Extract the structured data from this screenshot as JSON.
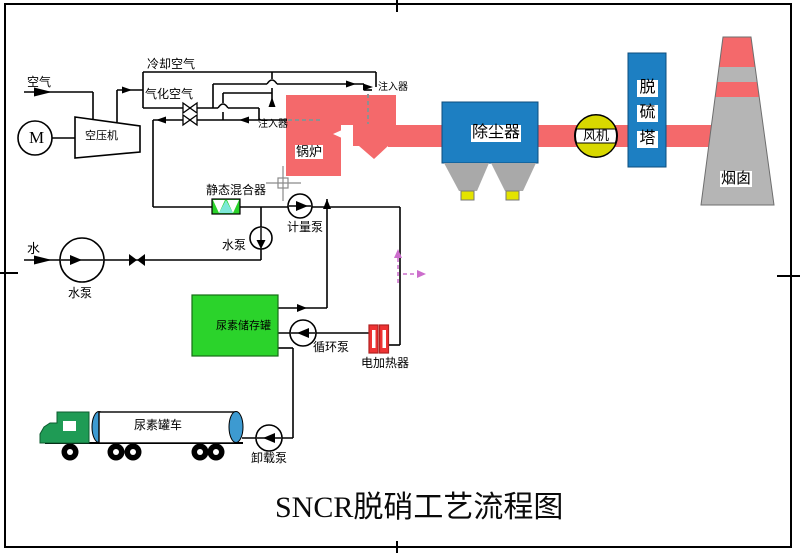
{
  "diagram": {
    "title": "SNCR脱硝工艺流程图",
    "labels": {
      "air": "空气",
      "cooling_air": "冷却空气",
      "atomizing_air": "气化空气",
      "compressor": "空压机",
      "motor": "M",
      "injector_left": "注入器",
      "injector_right": "注入器",
      "boiler": "锅炉",
      "dust_collector": "除尘器",
      "fan": "风机",
      "desulf_tower_chars": [
        "脱",
        "硫",
        "塔"
      ],
      "chimney": "烟囱",
      "static_mixer": "静态混合器",
      "metering_pump": "计量泵",
      "water": "水",
      "water_pump_main": "水泵",
      "water_pump_booster": "水泵",
      "urea_tank": "尿素储存罐",
      "circulation_pump": "循环泵",
      "electric_heater": "电加热器",
      "urea_truck": "尿素罐车",
      "unloading_pump": "卸载泵"
    },
    "colors": {
      "flue_red": "#f4696b",
      "equip_blue": "#1d7fc2",
      "tank_green": "#2bd32b",
      "cab_green": "#1f9b55",
      "fan_yellow": "#d8d800",
      "outlet_yellow": "#e3e300",
      "hopper_gray": "#a9a9a9",
      "chimney_gray": "#b5b5b5",
      "heater_red": "#ee3333",
      "truck_blue": "#3d9ad1",
      "mixer_cyan": "#7de8d8",
      "cursor_pink": "#cc6dcc"
    }
  }
}
